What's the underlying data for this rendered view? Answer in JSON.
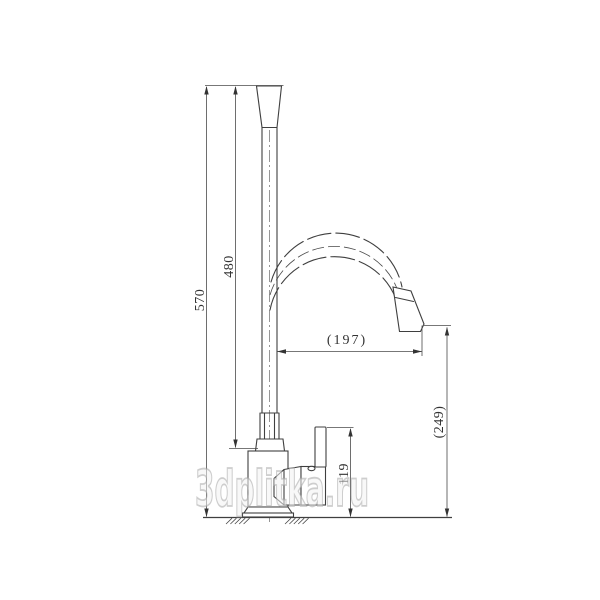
{
  "dimensions": {
    "total_height": "570",
    "spout_height": "480",
    "spout_reach": "(197)",
    "outlet_height": "(249)",
    "handle_height": "119"
  },
  "watermark": {
    "text": "3dplitka.ru"
  },
  "colors": {
    "line": "#3f3f3f",
    "dimension_line": "#4a4a4a",
    "dimension_text": "#333333",
    "watermark": "#c9c9c9",
    "background": "#ffffff"
  }
}
